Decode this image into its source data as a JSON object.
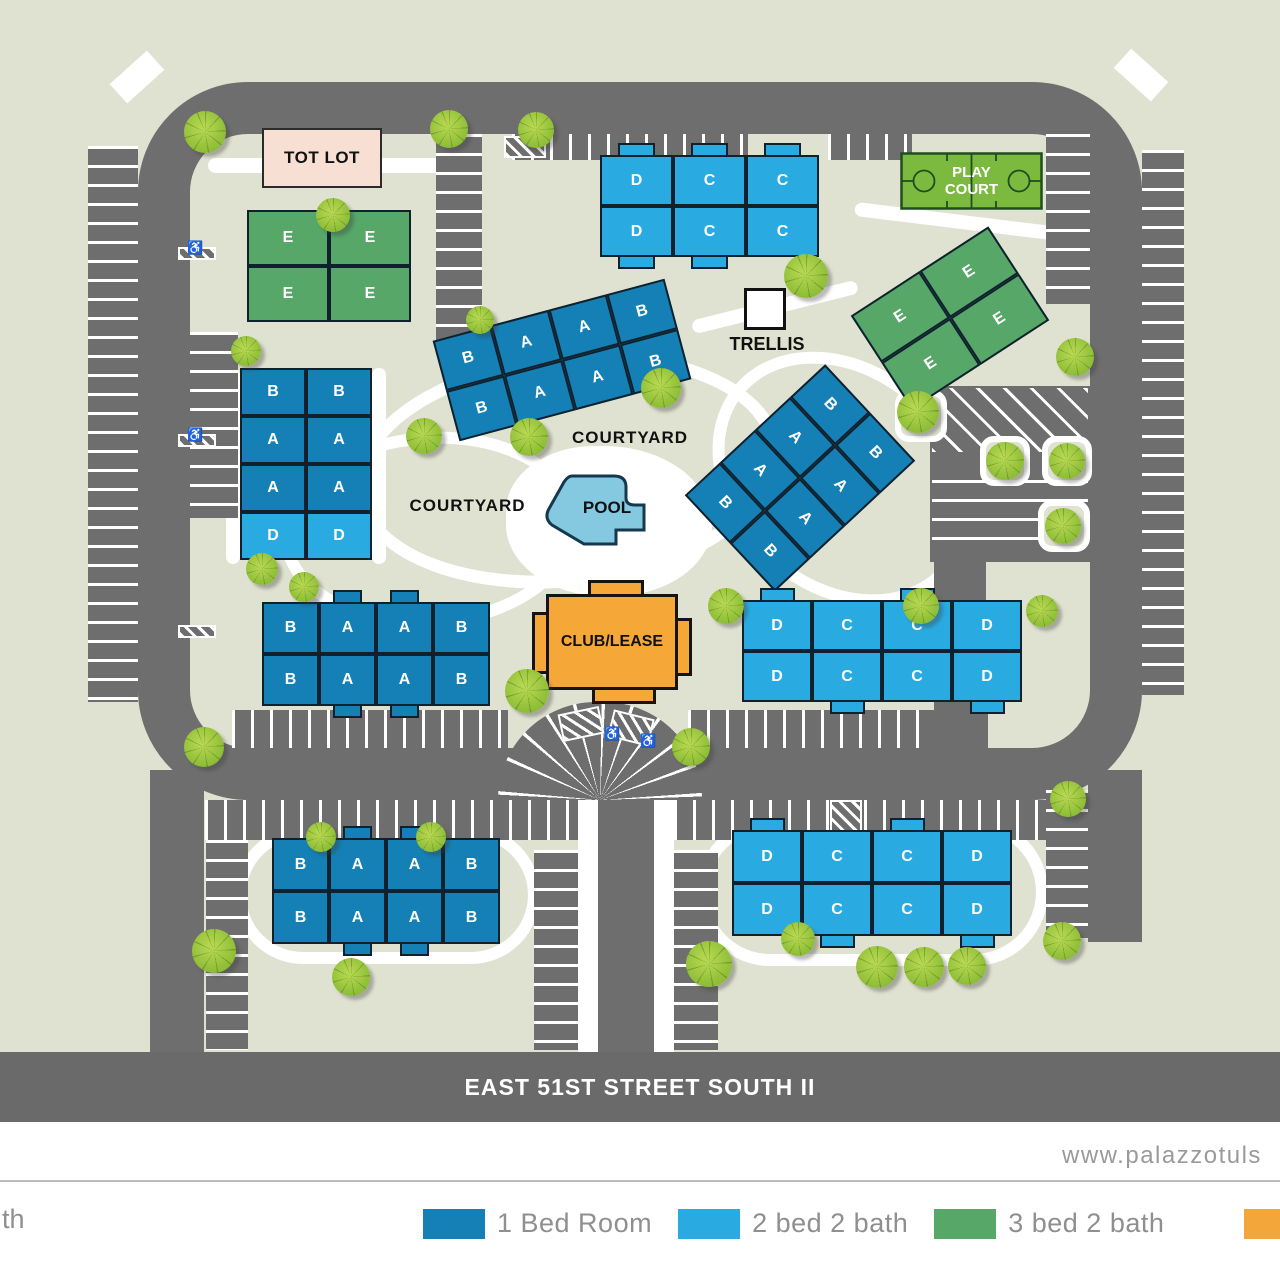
{
  "street": {
    "label": "EAST 51ST STREET SOUTH II"
  },
  "footer": {
    "website": "www.palazzotuls",
    "legend_cutoff_fragment": "th"
  },
  "amenities": {
    "tot_lot": "TOT LOT",
    "play_court": "PLAY COURT",
    "trellis": "TRELLIS",
    "pool": "POOL",
    "club": "CLUB/LEASE",
    "courtyard_center": "COURTYARD",
    "courtyard_west": "COURTYARD"
  },
  "unit_colors": {
    "one_bed": "#1580B5",
    "two_bed": "#29ABE2",
    "three_bed": "#56A768"
  },
  "legend": {
    "items": [
      {
        "label": "1 Bed Room",
        "color": "#1580B5"
      },
      {
        "label": "2 bed 2 bath",
        "color": "#29ABE2"
      },
      {
        "label": "3 bed 2 bath",
        "color": "#56A768"
      },
      {
        "label": "",
        "color": "#F3A73B"
      }
    ]
  },
  "buildings": [
    {
      "id": "e-cluster-nw",
      "type": "three_bed",
      "rows": [
        [
          "E",
          "E"
        ],
        [
          "E",
          "E"
        ]
      ]
    },
    {
      "id": "dcc-north",
      "type": "two_bed",
      "rows": [
        [
          "D",
          "C",
          "C"
        ],
        [
          "D",
          "C",
          "C"
        ]
      ]
    },
    {
      "id": "e-cluster-east",
      "type": "three_bed",
      "rows": [
        [
          "E",
          "E"
        ],
        [
          "E",
          "E"
        ]
      ]
    },
    {
      "id": "baab-center",
      "type": "one_bed",
      "rows": [
        [
          "B",
          "A",
          "A",
          "B"
        ],
        [
          "B",
          "A",
          "A",
          "B"
        ]
      ]
    },
    {
      "id": "stack-west",
      "type": "one_bed",
      "rows": [
        [
          "B",
          "B"
        ],
        [
          "A",
          "A"
        ],
        [
          "A",
          "A"
        ],
        [
          "D",
          "D"
        ]
      ],
      "row_types": [
        "one_bed",
        "one_bed",
        "one_bed",
        "two_bed"
      ]
    },
    {
      "id": "stack-east",
      "type": "one_bed",
      "rows": [
        [
          "B",
          "B"
        ],
        [
          "A",
          "A"
        ],
        [
          "A",
          "A"
        ],
        [
          "B",
          "B"
        ]
      ]
    },
    {
      "id": "baab-west",
      "type": "one_bed",
      "rows": [
        [
          "B",
          "A",
          "A",
          "B"
        ],
        [
          "B",
          "A",
          "A",
          "B"
        ]
      ]
    },
    {
      "id": "dccd-east",
      "type": "two_bed",
      "rows": [
        [
          "D",
          "C",
          "C",
          "D"
        ],
        [
          "D",
          "C",
          "C",
          "D"
        ]
      ]
    },
    {
      "id": "baab-south",
      "type": "one_bed",
      "rows": [
        [
          "B",
          "A",
          "A",
          "B"
        ],
        [
          "B",
          "A",
          "A",
          "B"
        ]
      ]
    },
    {
      "id": "dccd-south",
      "type": "two_bed",
      "rows": [
        [
          "D",
          "C",
          "C",
          "D"
        ],
        [
          "D",
          "C",
          "C",
          "D"
        ]
      ]
    }
  ]
}
